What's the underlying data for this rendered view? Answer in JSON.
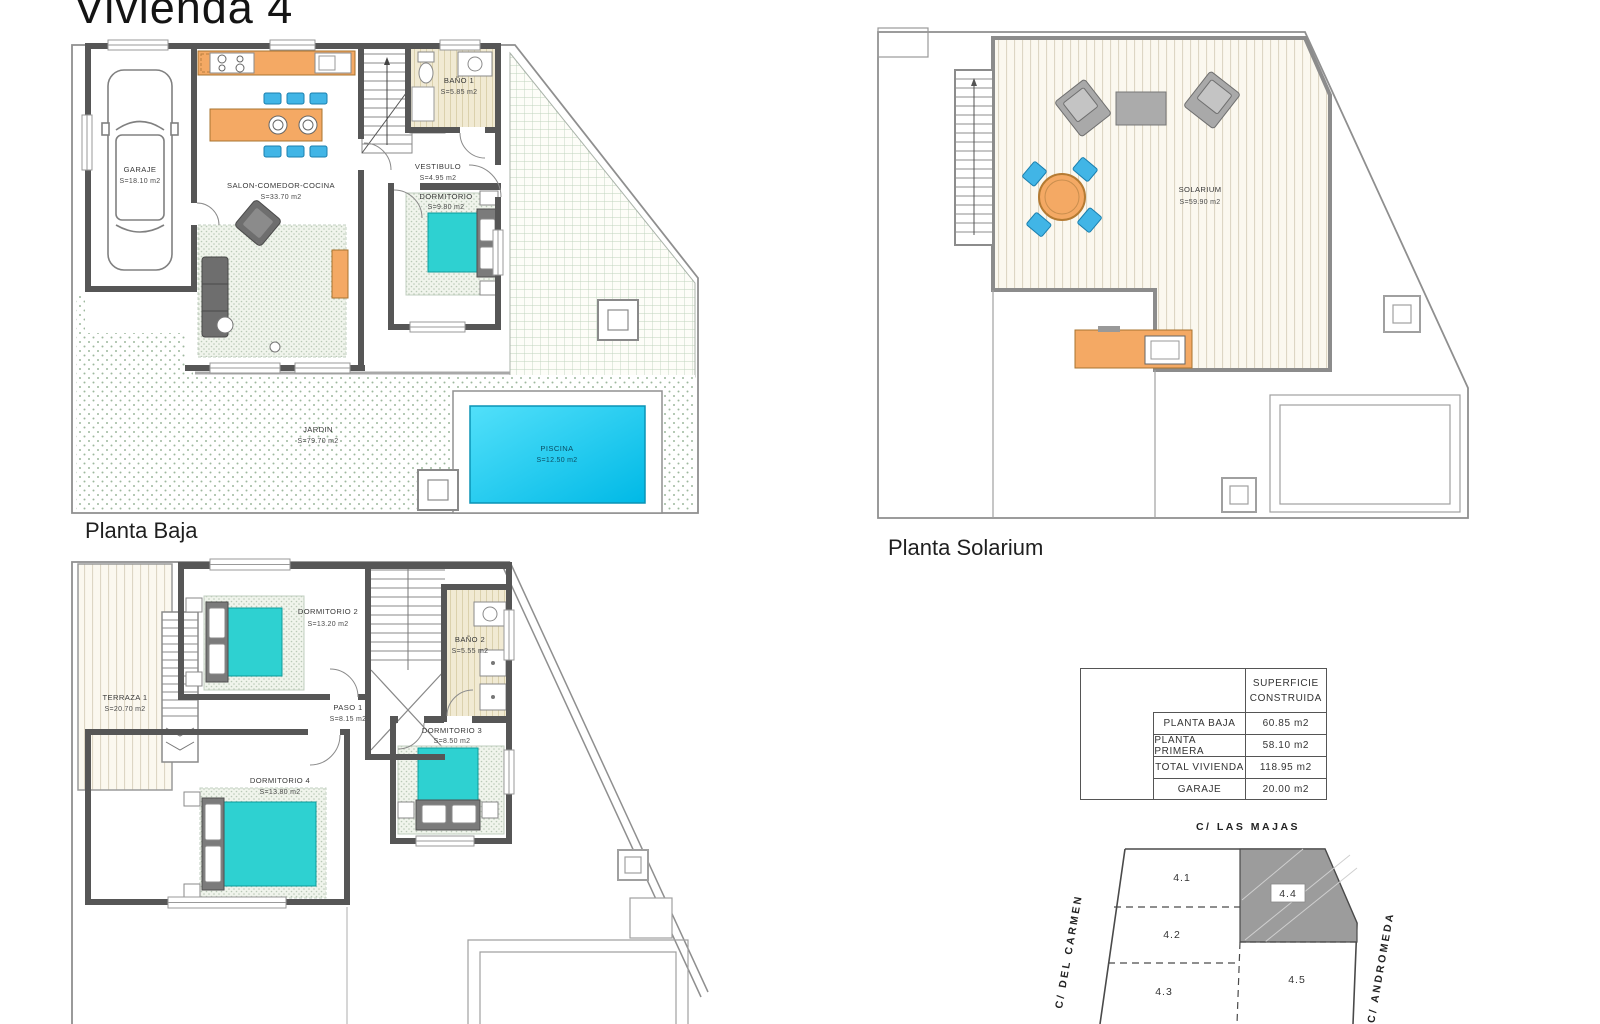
{
  "title": "Vivienda 4",
  "planta_baja": {
    "label": "Planta Baja",
    "rooms": [
      {
        "name": "GARAJE",
        "area": "S=18.10 m2"
      },
      {
        "name": "SALON-COMEDOR-COCINA",
        "area": "S=33.70 m2"
      },
      {
        "name": "BAÑO 1",
        "area": "S=5.85 m2"
      },
      {
        "name": "VESTIBULO",
        "area": "S=4.95 m2"
      },
      {
        "name": "DORMITORIO",
        "area": "S=9.80 m2"
      },
      {
        "name": "JARDIN",
        "area": "S=79.70 m2"
      },
      {
        "name": "PISCINA",
        "area": "S=12.50 m2"
      }
    ]
  },
  "planta_solarium": {
    "label": "Planta Solarium",
    "rooms": [
      {
        "name": "SOLARIUM",
        "area": "S=59.90 m2"
      }
    ]
  },
  "planta_primera": {
    "rooms": [
      {
        "name": "TERRAZA 1",
        "area": "S=20.70 m2"
      },
      {
        "name": "DORMITORIO 2",
        "area": "S=13.20 m2"
      },
      {
        "name": "PASO 1",
        "area": "S=8.15 m2"
      },
      {
        "name": "BAÑO 2",
        "area": "S=5.55 m2"
      },
      {
        "name": "DORMITORIO 3",
        "area": "S=8.50 m2"
      },
      {
        "name": "DORMITORIO 4",
        "area": "S=13.80 m2"
      }
    ]
  },
  "surface_table": {
    "header_line1": "SUPERFICIE",
    "header_line2": "CONSTRUIDA",
    "rows": [
      {
        "label": "PLANTA BAJA",
        "value": "60.85 m2"
      },
      {
        "label": "PLANTA PRIMERA",
        "value": "58.10 m2"
      },
      {
        "label": "TOTAL VIVIENDA",
        "value": "118.95 m2"
      },
      {
        "label": "GARAJE",
        "value": "20.00 m2"
      }
    ]
  },
  "site_plan": {
    "street_top": "C/  LAS  MAJAS",
    "street_left": "C/  DEL  CARMEN",
    "street_right": "C/  ANDROMEDA",
    "plots": [
      "4.1",
      "4.2",
      "4.3",
      "4.4",
      "4.5"
    ],
    "highlighted_plot": "4.4"
  },
  "colors": {
    "wall": "#565656",
    "counter_orange": "#f4a964",
    "bed_teal": "#2ed1d1",
    "chair_blue": "#41b5e6",
    "pool_light": "#52e0fa",
    "pool_deep": "#00b9e6",
    "highlight_plot_fill": "#9c9c9c"
  }
}
